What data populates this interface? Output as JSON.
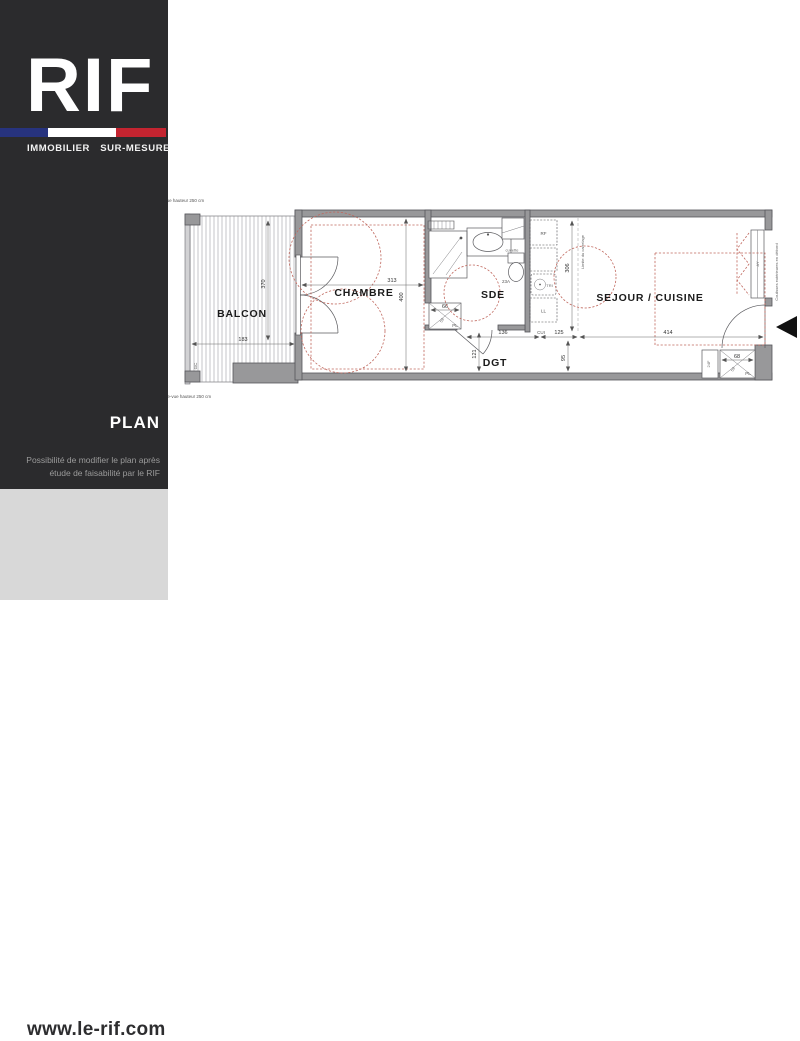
{
  "sidebar": {
    "logo_text": "RIF",
    "tagline": "IMMOBILIER SUR-MESURE",
    "section_title": "PLAN",
    "note_line1": "Possibilité de modifier le plan après",
    "note_line2": "étude de faisabilité par le RIF",
    "website": "www.le-rif.com",
    "colors": {
      "background": "#2b2b2d",
      "footer_background": "#d8d8d8",
      "flag_blue": "#27337e",
      "flag_white": "#ffffff",
      "flag_red": "#c42430"
    }
  },
  "plan": {
    "rooms": {
      "balcon": "BALCON",
      "chambre": "CHAMBRE",
      "sde": "SDE",
      "dgt": "DGT",
      "sejour": "SEJOUR / CUISINE"
    },
    "dimensions": {
      "balcon_width": "183",
      "balcon_depth": "370",
      "chambre_width": "313",
      "chambre_depth": "400",
      "dgt_width": "136",
      "cuisine_width": "125",
      "sejour_width": "414",
      "cuisine_depth": "306",
      "dgt_depth": "121",
      "entry_depth": "95",
      "closet_dgt_width": "66",
      "closet_entry_width": "68",
      "closet_depth": "59",
      "door_tag": "23A",
      "window_tag": "AY",
      "entry_closet_tag": "24F"
    },
    "labels": {
      "pare_vue_top": "pare-vue hauteur 250 cm",
      "pare_vue_bottom": "pare-vue hauteur 250 cm",
      "gc": "GC",
      "limite_carrelage": "Limite du carrelage",
      "coulisses": "Coulisses extérieures en débord",
      "cuvette": "cuvette",
      "rf": "RF",
      "tri": "TRI",
      "ll": "LL",
      "cui": "CUI",
      "pl": "PL"
    },
    "colors": {
      "wall": "#98989a",
      "line": "#55555a",
      "furniture_dashed": "#c0685e"
    }
  }
}
